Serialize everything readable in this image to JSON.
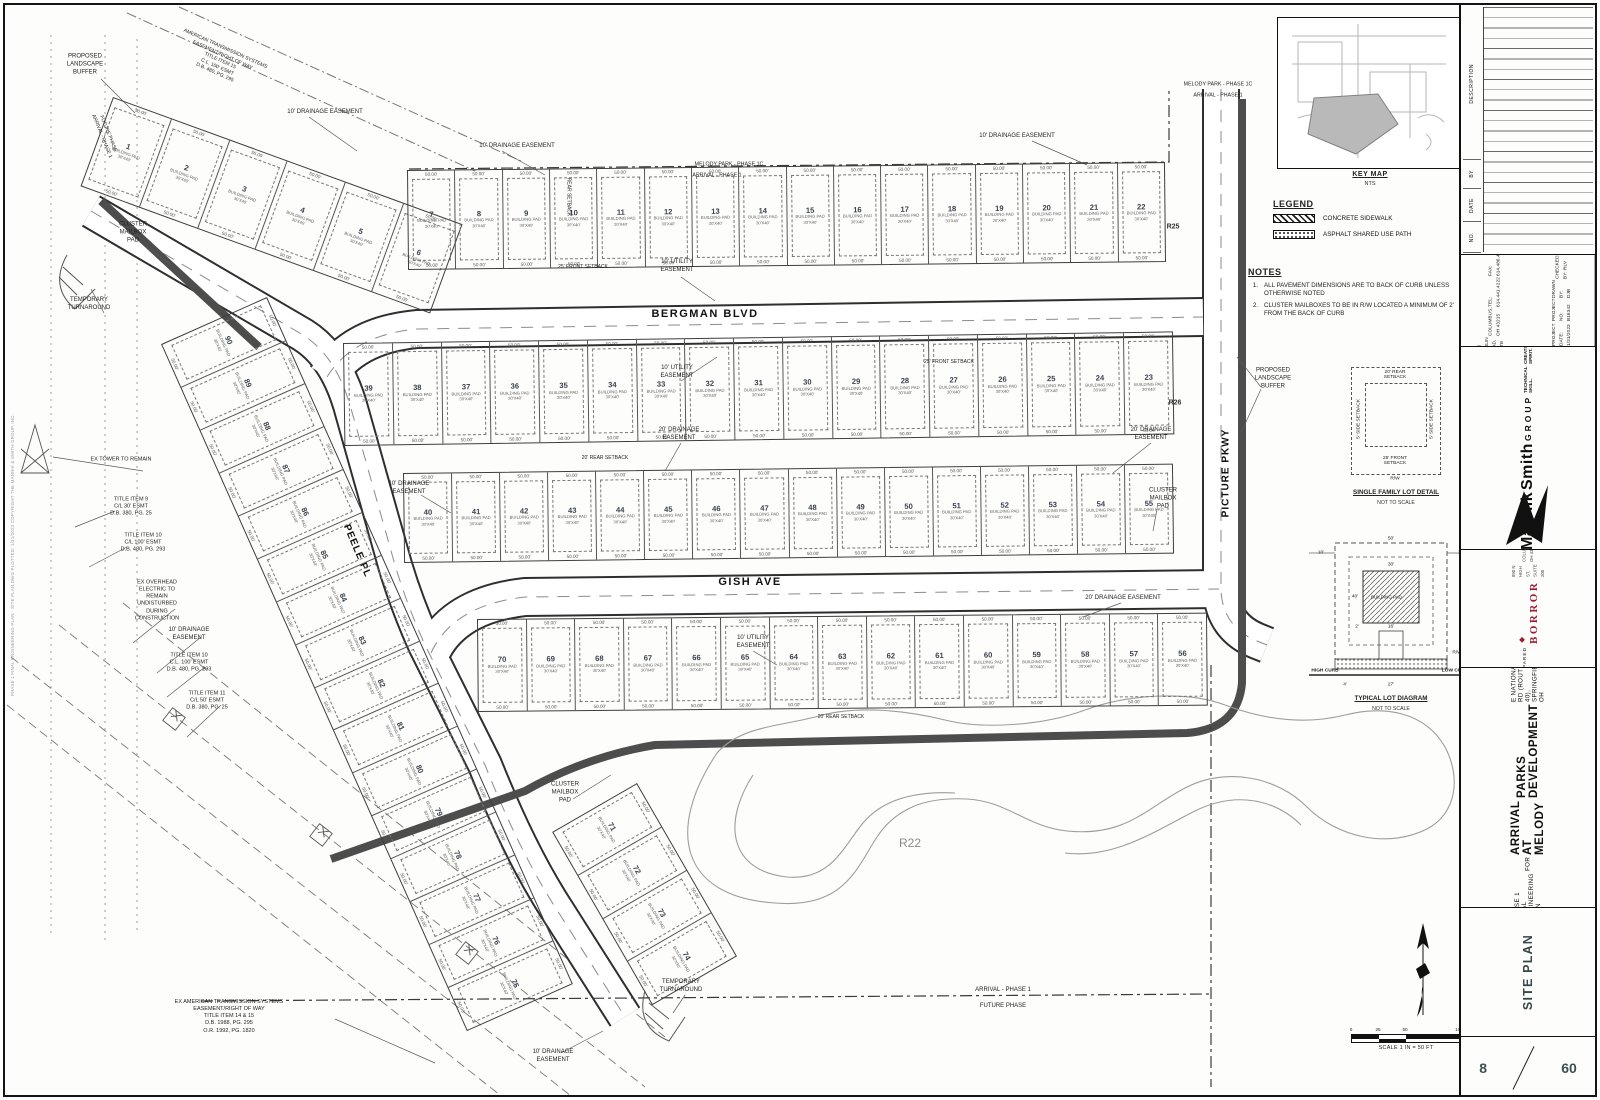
{
  "sheet": {
    "scale_text": "SCALE  1 IN = 50 FT",
    "scale_ticks": [
      "0",
      "25",
      "50",
      "100"
    ],
    "plot_stamp": "PHASE 1 FINAL ENGINEERING PLAN - SITE PLAN.DWG   PLOTTED: 1/31/2023   COPYRIGHT THE MANNIK & SMITH GROUP, INC."
  },
  "key_map": {
    "title": "KEY MAP",
    "subtitle": "NTS"
  },
  "legend": {
    "title": "LEGEND",
    "items": [
      {
        "label": "CONCRETE SIDEWALK",
        "swatch": "concrete"
      },
      {
        "label": "ASPHALT SHARED USE PATH",
        "swatch": "asphalt"
      }
    ]
  },
  "notes": {
    "title": "NOTES",
    "items": [
      {
        "num": "1.",
        "text": "ALL PAVEMENT DIMENSIONS ARE TO BACK OF CURB UNLESS OTHERWISE NOTED"
      },
      {
        "num": "2.",
        "text": "CLUSTER MAILBOXES TO BE IN R/W LOCATED A MINIMUM OF 2' FROM THE BACK OF CURB"
      }
    ]
  },
  "details": {
    "single_family": {
      "caption": "SINGLE FAMILY LOT DETAIL",
      "scale": "NOT TO SCALE",
      "rear": "20' REAR\nSETBACK",
      "front": "25' FRONT\nSETBACK",
      "side_left": "5' SIDE SETBACK",
      "side_right": "5' SIDE SETBACK",
      "rw": "R/W"
    },
    "typical_lot": {
      "caption": "TYPICAL LOT DIAGRAM",
      "scale": "NOT TO SCALE",
      "high_curb": "HIGH CURB",
      "low_curb": "LOW CURB",
      "building_pad": "BUILDING PAD",
      "rw": "R/W",
      "dims": {
        "w50": "50'",
        "s10a": "10'",
        "s10b": "10'",
        "w30": "30'",
        "d40": "40'",
        "d2": "2'",
        "d16": "16'",
        "d4": "4'",
        "d27": "27'"
      }
    }
  },
  "basin_label": "R22",
  "plan": {
    "streets": {
      "bergman": "BERGMAN BLVD",
      "gish": "GISH AVE",
      "peele": "PEELE PL",
      "picture": "PICTURE PKWY"
    },
    "lot_defaults": {
      "pad_line1": "BUILDING PAD",
      "pad_line2": "30'X40'"
    },
    "lot_rows": [
      {
        "id": "1-6",
        "x": 108,
        "y": 92,
        "w": 372,
        "h": 95,
        "rot": 20,
        "dim": "50.00'",
        "lots": [
          "1",
          "2",
          "3",
          "4",
          "5",
          "6"
        ]
      },
      {
        "id": "7-22",
        "x": 402,
        "y": 165,
        "w": 758,
        "h": 100,
        "rot": -0.6,
        "dim": "50.00'",
        "lots": [
          "7",
          "8",
          "9",
          "10",
          "11",
          "12",
          "13",
          "14",
          "15",
          "16",
          "17",
          "18",
          "19",
          "20",
          "21",
          "22"
        ]
      },
      {
        "id": "23-39",
        "x": 338,
        "y": 338,
        "w": 830,
        "h": 103,
        "rot": -0.8,
        "dim": "50.00'",
        "lots": [
          "39",
          "38",
          "37",
          "36",
          "35",
          "34",
          "33",
          "32",
          "31",
          "30",
          "29",
          "28",
          "27",
          "26",
          "25",
          "24",
          "23"
        ]
      },
      {
        "id": "40-55",
        "x": 398,
        "y": 468,
        "w": 770,
        "h": 90,
        "rot": -0.7,
        "dim": "50.00'",
        "lots": [
          "40",
          "41",
          "42",
          "43",
          "44",
          "45",
          "46",
          "47",
          "48",
          "49",
          "50",
          "51",
          "52",
          "53",
          "54",
          "55"
        ]
      },
      {
        "id": "56-70",
        "x": 472,
        "y": 614,
        "w": 730,
        "h": 93,
        "rot": -0.5,
        "dim": "50.00'",
        "lots": [
          "70",
          "69",
          "68",
          "67",
          "66",
          "65",
          "64",
          "63",
          "62",
          "61",
          "60",
          "59",
          "58",
          "57",
          "56"
        ]
      },
      {
        "id": "75-90",
        "x": 262,
        "y": 292,
        "w": 752,
        "h": 116,
        "rot": 66,
        "dim": "50.00'",
        "lots": [
          "90",
          "89",
          "88",
          "87",
          "86",
          "85",
          "84",
          "83",
          "82",
          "81",
          "80",
          "79",
          "78",
          "77",
          "76",
          "75"
        ]
      },
      {
        "id": "71-74",
        "x": 632,
        "y": 778,
        "w": 200,
        "h": 98,
        "rot": 60,
        "dim": "50.00'",
        "lots": [
          "71",
          "72",
          "73",
          "74"
        ]
      }
    ],
    "callouts": [
      {
        "t": "PROPOSED\nLANDSCAPE\nBUFFER",
        "x": 80,
        "y": 60
      },
      {
        "t": "AMERICAN TRANSMISSION SYSTEMS\nEASEMENT/RIGHT OF WAY\nTITLE ITEM 15\nC.L. 100' ESMT\nD.B. 480, PG. 295",
        "x": 215,
        "y": 56,
        "r": 24,
        "fs": 5
      },
      {
        "t": "10' DRAINAGE EASEMENT",
        "x": 320,
        "y": 108
      },
      {
        "t": "10' DRAINAGE EASEMENT",
        "x": 512,
        "y": 142
      },
      {
        "t": "10' DRAINAGE EASEMENT",
        "x": 1012,
        "y": 132
      },
      {
        "t": "CLUSTER\nMAILBOX\nPAD",
        "x": 128,
        "y": 228
      },
      {
        "t": "TEMPORARY\nTURNAROUND",
        "x": 84,
        "y": 300
      },
      {
        "t": "FUTURE PHASE\nARRIVAL - PHASE 1",
        "x": 100,
        "y": 130,
        "r": 68,
        "fs": 5
      },
      {
        "t": "EX TOWER TO REMAIN",
        "x": 116,
        "y": 455,
        "fs": 5.5
      },
      {
        "t": "TITLE ITEM 9\nC/L 30' ESMT\nD.B. 380, PG. 25",
        "x": 126,
        "y": 502,
        "fs": 5.5
      },
      {
        "t": "TITLE ITEM 10\nC/L 100' ESMT\nD.B. 480, PG. 293",
        "x": 138,
        "y": 538,
        "fs": 5.5
      },
      {
        "t": "EX OVERHEAD\nELECTRIC TO\nREMAIN\nUNDISTURBED\nDURING\nCONSTRUCTION",
        "x": 152,
        "y": 596,
        "fs": 5.5
      },
      {
        "t": "10' DRAINAGE\nEASEMENT",
        "x": 184,
        "y": 630
      },
      {
        "t": "TITLE ITEM 10\nC.L. 100' ESMT\nD.B. 480, PG. 293",
        "x": 184,
        "y": 658,
        "fs": 5.5
      },
      {
        "t": "TITLE ITEM 11\nC/L 50' ESMT\nD.B. 380, PG. 25",
        "x": 202,
        "y": 696,
        "fs": 5.5
      },
      {
        "t": "EX AMERICAN TRANSMISSION SYSTEMS\nEASEMENT/RIGHT OF WAY\nTITLE ITEM 14 & 15\nD.B. 1988, PG. 295\nO.R. 1992, PG. 1820",
        "x": 224,
        "y": 1012,
        "fs": 5.5
      },
      {
        "t": "10' DRAINAGE\nEASEMENT",
        "x": 404,
        "y": 484
      },
      {
        "t": "CLUSTER\nMAILBOX\nPAD",
        "x": 560,
        "y": 788
      },
      {
        "t": "TEMPORARY\nTURNAROUND",
        "x": 676,
        "y": 982
      },
      {
        "t": "10' DRAINAGE\nEASEMENT",
        "x": 548,
        "y": 1052
      },
      {
        "t": "10' UTILITY\nEASEMENT",
        "x": 672,
        "y": 262
      },
      {
        "t": "10' UTILITY\nEASEMENT",
        "x": 672,
        "y": 368
      },
      {
        "t": "25' FRONT SETBACK",
        "x": 578,
        "y": 262,
        "fs": 5
      },
      {
        "t": "REAR SETBACK",
        "x": 563,
        "y": 192,
        "r": 90,
        "fs": 5
      },
      {
        "t": "20' REAR SETBACK",
        "x": 600,
        "y": 453,
        "fs": 5
      },
      {
        "t": "25' FRONT SETBACK",
        "x": 944,
        "y": 357,
        "fs": 5
      },
      {
        "t": "20' DRAINAGE\nEASEMENT",
        "x": 674,
        "y": 430
      },
      {
        "t": "20' DRAINAGE\nEASEMENT",
        "x": 1146,
        "y": 430
      },
      {
        "t": "CLUSTER\nMAILBOX\nPAD",
        "x": 1158,
        "y": 494
      },
      {
        "t": "20' DRAINAGE EASEMENT",
        "x": 1118,
        "y": 594
      },
      {
        "t": "10' UTILITY\nEASEMENT",
        "x": 748,
        "y": 638
      },
      {
        "t": "20' REAR SETBACK",
        "x": 836,
        "y": 712,
        "fs": 5
      },
      {
        "t": "PROPOSED\nLANDSCAPE\nBUFFER",
        "x": 1268,
        "y": 374
      },
      {
        "t": "R25",
        "x": 1168,
        "y": 222,
        "cls": "curve"
      },
      {
        "t": "R26",
        "x": 1170,
        "y": 398,
        "cls": "curve"
      },
      {
        "t": "MELODY PARK - PHASE 1C",
        "x": 724,
        "y": 160,
        "fs": 5.3
      },
      {
        "t": "ARRIVAL - PHASE 1",
        "x": 712,
        "y": 171,
        "fs": 5.3
      },
      {
        "t": "MELODY PARK - PHASE 1C",
        "x": 1213,
        "y": 80,
        "fs": 5.3
      },
      {
        "t": "ARRIVAL - PHASE 1",
        "x": 1213,
        "y": 91,
        "fs": 5.3
      },
      {
        "t": "ARRIVAL - PHASE 1",
        "x": 998,
        "y": 986,
        "fs": 6
      },
      {
        "t": "FUTURE PHASE",
        "x": 998,
        "y": 1002,
        "fs": 6
      }
    ]
  },
  "title_block": {
    "rev": {
      "headers": [
        "NO.",
        "DATE",
        "BY",
        "DESCRIPTION"
      ]
    },
    "firm": {
      "address": [
        "1160 DUBLIN ROAD, SUITE 100",
        "COLUMBUS, OH 43215",
        "TEL: 614.441.4222",
        "FAX: 614.486.4387"
      ],
      "fields": [
        {
          "label": "PROJECT DATE:",
          "value": "1/31/2023"
        },
        {
          "label": "PROJECT NO:",
          "value": "B16342"
        },
        {
          "label": "DRAWN BY:",
          "value": "DJB"
        },
        {
          "label": "CHECKED BY:",
          "value": "RLV"
        }
      ]
    },
    "firm_logo": {
      "line1": "Mannik",
      "line2": "Smith",
      "line3": "GROUP",
      "tagline1": "TECHNICAL SKILL.",
      "tagline2": "CREATIVE SPIRIT.",
      "website": "www.MannikSmithGroup.com"
    },
    "prepared_for": {
      "label": "PREPARED FOR",
      "logo": "BORROR",
      "address": [
        "890 N HIGH ST, SUITE 200",
        "COLUMBUS, OH 43215"
      ]
    },
    "project": {
      "line1": "PHASE 1 FINAL ENGINEERING PLAN",
      "line2": "FOR",
      "line3": "ARRIVAL AT MELODY",
      "line4": "PARKS DEVELOPMENT",
      "line5": "E NATIONAL RD (ROUTE 40), SPRINGFIELD, OH"
    },
    "sheet_title": "SITE PLAN",
    "sheet_no": "8",
    "sheet_total": "60"
  }
}
